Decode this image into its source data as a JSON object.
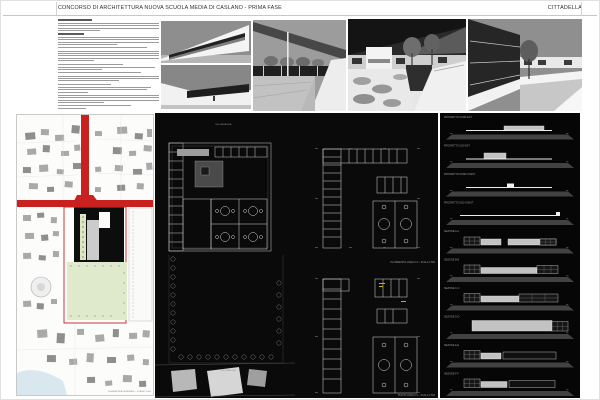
{
  "header": {
    "title": "CONCORSO DI ARCHITETTURA NUOVA SCUOLA MEDIA DI CASLANO - PRIMA FASE",
    "motto": "CITTADELLA"
  },
  "text_block": {
    "groups": [
      {
        "bold": true,
        "lines": [
          34
        ]
      },
      {
        "bold": false,
        "lines": [
          100,
          100,
          100,
          42
        ]
      },
      {
        "bold": true,
        "lines": [
          26
        ]
      },
      {
        "bold": false,
        "lines": [
          100,
          100,
          100,
          58
        ]
      },
      {
        "bold": false,
        "lines": [
          88
        ]
      },
      {
        "bold": false,
        "lines": [
          100,
          100,
          100,
          100,
          36
        ]
      },
      {
        "bold": false,
        "lines": [
          64
        ]
      },
      {
        "bold": false,
        "lines": [
          96,
          44
        ]
      },
      {
        "bold": false,
        "lines": [
          82
        ]
      },
      {
        "bold": false,
        "lines": [
          100,
          100,
          60
        ]
      },
      {
        "bold": false,
        "lines": [
          52
        ]
      },
      {
        "bold": false,
        "lines": [
          92,
          88,
          30
        ]
      },
      {
        "bold": false,
        "lines": [
          100,
          100,
          100,
          46
        ]
      },
      {
        "bold": false,
        "lines": [
          72,
          28
        ]
      }
    ]
  },
  "site_plan": {
    "caption": "PLANIMETRIA GENERALE - SCALA 1:2000"
  },
  "plans": {
    "caption_mid": "PLANIMETRIA LIVELLO 1 - SCALA 1:500",
    "caption_bottom": "PIANTA LIVELLO 2 - SCALA 1:500",
    "caption_left_top": "VIA CAMPAGNA",
    "caption_left_bottom": "VIA STAZIONE"
  },
  "elevations": {
    "accent_ground": "#424242",
    "strips": [
      {
        "label": "PROSPETTO NORD-EST",
        "shapes": [
          [
            "l",
            26,
            17,
            86,
            1
          ],
          [
            "r",
            64,
            13,
            40,
            4,
            "a"
          ]
        ]
      },
      {
        "label": "PROSPETTO SUD-EST",
        "shapes": [
          [
            "l",
            26,
            17,
            86,
            1
          ],
          [
            "r",
            44,
            11.5,
            22,
            5.5,
            "a"
          ]
        ]
      },
      {
        "label": "PROSPETTO NORD-OVEST",
        "shapes": [
          [
            "l",
            26,
            17,
            86,
            1
          ],
          [
            "r",
            67,
            13.5,
            7,
            3.5,
            "w"
          ]
        ]
      },
      {
        "label": "PROSPETTO SUD-OVEST",
        "shapes": [
          [
            "l",
            20,
            16.5,
            100,
            1
          ],
          [
            "r",
            116,
            13.5,
            4,
            3,
            "w"
          ]
        ]
      },
      {
        "label": "SEZIONE A-A",
        "shapes": [
          [
            "g",
            24,
            10,
            16,
            8
          ],
          [
            "r",
            41,
            12,
            20,
            6,
            "a"
          ],
          [
            "r",
            68,
            12,
            48,
            6,
            "a"
          ],
          [
            "g",
            100,
            12,
            16,
            6
          ]
        ]
      },
      {
        "label": "SEZIONE B-B",
        "shapes": [
          [
            "g",
            24,
            9.5,
            16,
            8.5
          ],
          [
            "r",
            41,
            12,
            56,
            6,
            "a"
          ],
          [
            "g",
            97,
            10,
            21,
            8
          ]
        ]
      },
      {
        "label": "SEZIONE C-C",
        "shapes": [
          [
            "g",
            24,
            9.5,
            16,
            8.5
          ],
          [
            "r",
            41,
            12,
            38,
            6,
            "a"
          ],
          [
            "g",
            79,
            10,
            39,
            8
          ]
        ]
      },
      {
        "label": "SEZIONE D-D",
        "shapes": [
          [
            "r",
            32,
            8,
            80,
            10.5,
            "a"
          ],
          [
            "g",
            112,
            9,
            16,
            9.5
          ]
        ]
      },
      {
        "label": "SEZIONE E-E",
        "shapes": [
          [
            "g",
            24,
            9.5,
            16,
            8.5
          ],
          [
            "r",
            41,
            12,
            20,
            6,
            "a"
          ],
          [
            "r",
            63,
            11,
            53,
            7,
            "n"
          ]
        ]
      },
      {
        "label": "SEZIONE F-F",
        "shapes": [
          [
            "g",
            24,
            9.5,
            16,
            8.5
          ],
          [
            "r",
            41,
            12,
            26,
            6,
            "a"
          ],
          [
            "r",
            69,
            11,
            46,
            7,
            "n"
          ]
        ]
      }
    ]
  },
  "colors": {
    "road_red": "#c92020",
    "field_green": "#dfe9cb",
    "lake_blue": "#d9e7ee",
    "footprint_black": "#0d0d0d",
    "panel_black": "#0a0a0a"
  }
}
